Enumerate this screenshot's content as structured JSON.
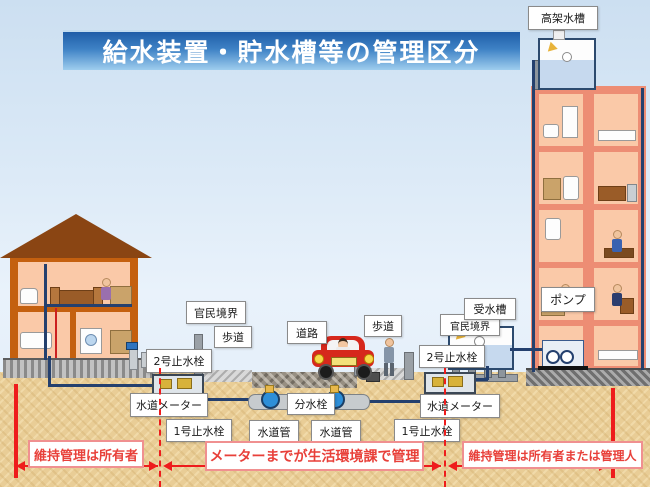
{
  "title": "給水装置・貯水槽等の管理区分",
  "labels": {
    "elevated_tank": "高架水槽",
    "pump": "ポンプ",
    "receiving_tank": "受水槽",
    "public_private_boundary": "官民境界",
    "sidewalk": "歩道",
    "road": "道路",
    "stop_valve_no2": "2号止水栓",
    "stop_valve_no1": "1号止水栓",
    "water_meter": "水道メーター",
    "water_pipe": "水道管",
    "branch_valve": "分水栓"
  },
  "management_zones": {
    "left": "維持管理は所有者",
    "center": "メーターまでが生活環境課で管理",
    "right": "維持管理は所有者または管理人"
  },
  "colors": {
    "banner_blue_top": "#1f5da8",
    "banner_blue_bottom": "#9ecdee",
    "boundary_red": "#ee1c1c",
    "zone_text_red": "#e8403a",
    "ground_sand": "#e9cd96",
    "house_wall_orange": "#c4600f",
    "house_roof_brown": "#8a4513",
    "building_salmon": "#ed8d74",
    "room_peach": "#fac9a8",
    "pipe_navy": "#24406e",
    "valve_blue": "#2e8fd8",
    "tank_water_blue": "#c6d9ee"
  }
}
